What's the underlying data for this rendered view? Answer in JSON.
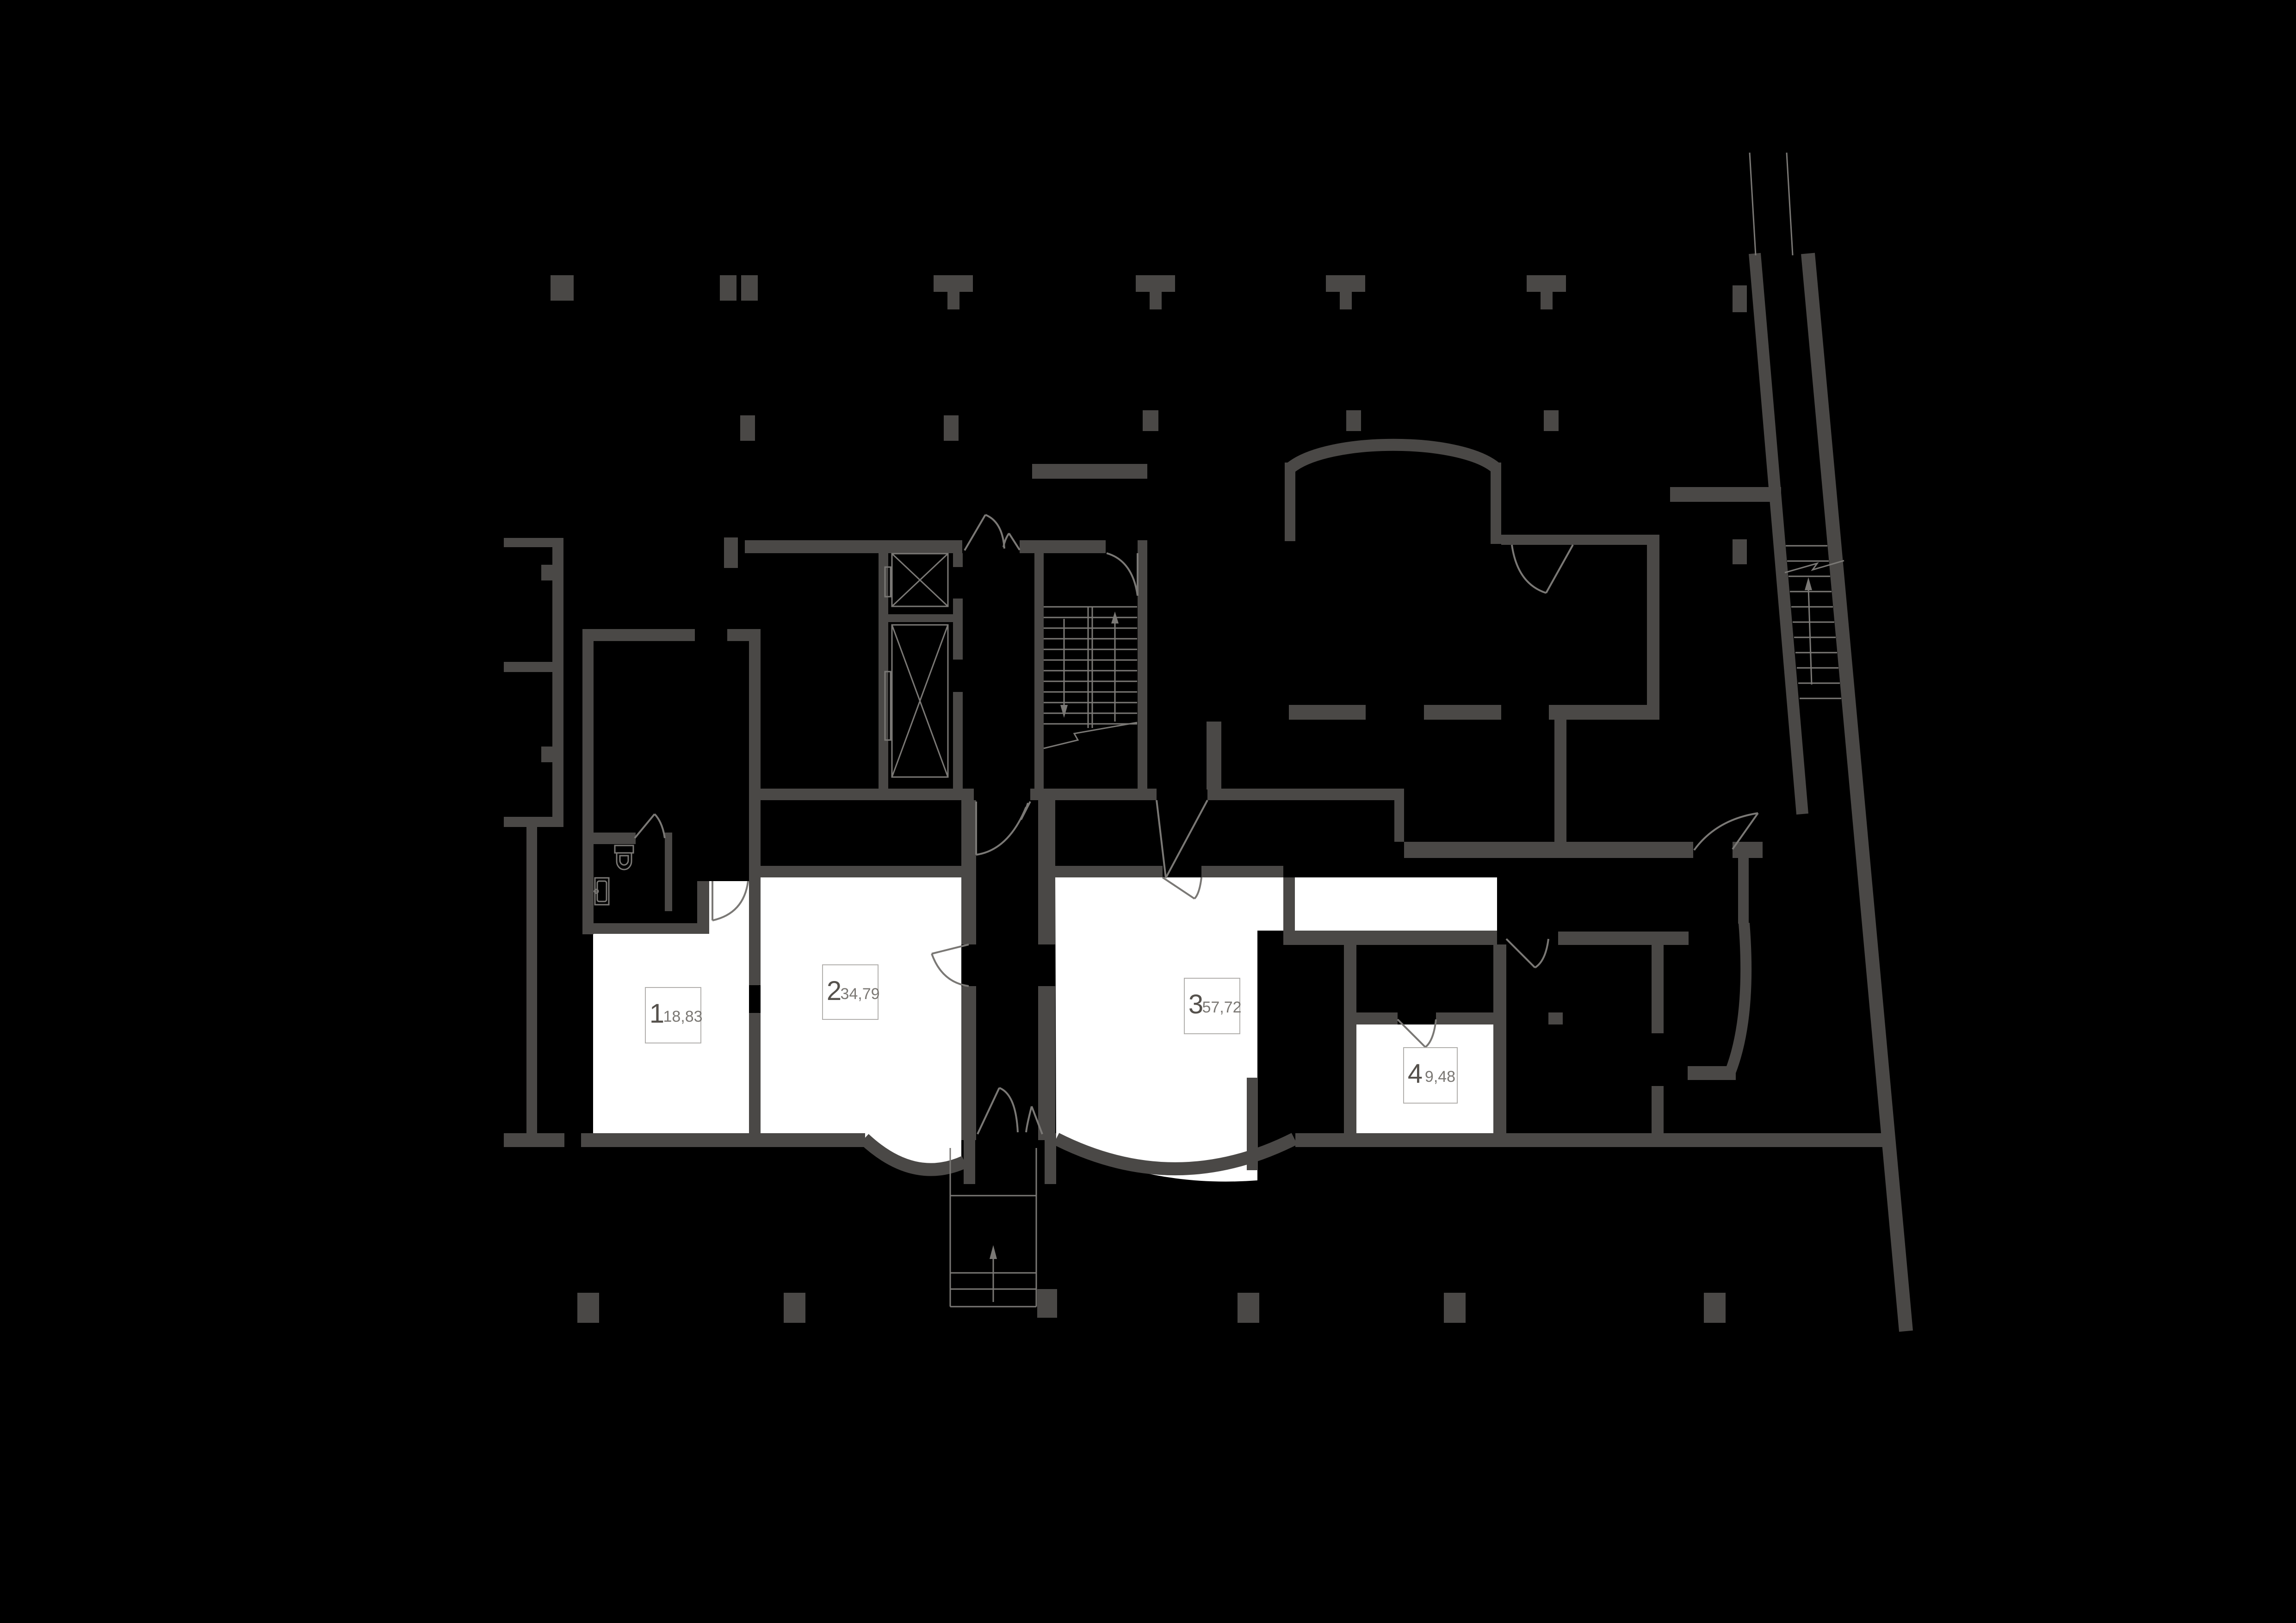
{
  "plan": {
    "title": "Floor plan — ground floor commercial units",
    "units": [
      {
        "number": "1",
        "area": "18,83"
      },
      {
        "number": "2",
        "area": "34,79"
      },
      {
        "number": "3",
        "area": "57,72"
      },
      {
        "number": "4",
        "area": "9,48"
      }
    ],
    "features": {
      "elevators": 2,
      "staircases": [
        "core-staircase",
        "external-staircase"
      ],
      "entrance": "bottom-center with steps and up-arrow",
      "fixtures": [
        "toilet-icon",
        "sink-icon"
      ]
    },
    "icons": [
      "toilet-icon",
      "sink-icon",
      "elevator-x-icon",
      "stair-treads-icon",
      "door-arc-icon",
      "up-arrow-icon",
      "down-arrow-icon"
    ],
    "colors": {
      "background": "#000000",
      "wall": "#4a4846",
      "thin_line": "#7a7875",
      "room_fill": "#ffffff",
      "label_number": "#55514c",
      "label_area": "#7b7874",
      "label_border": "#b2b0ad"
    }
  }
}
